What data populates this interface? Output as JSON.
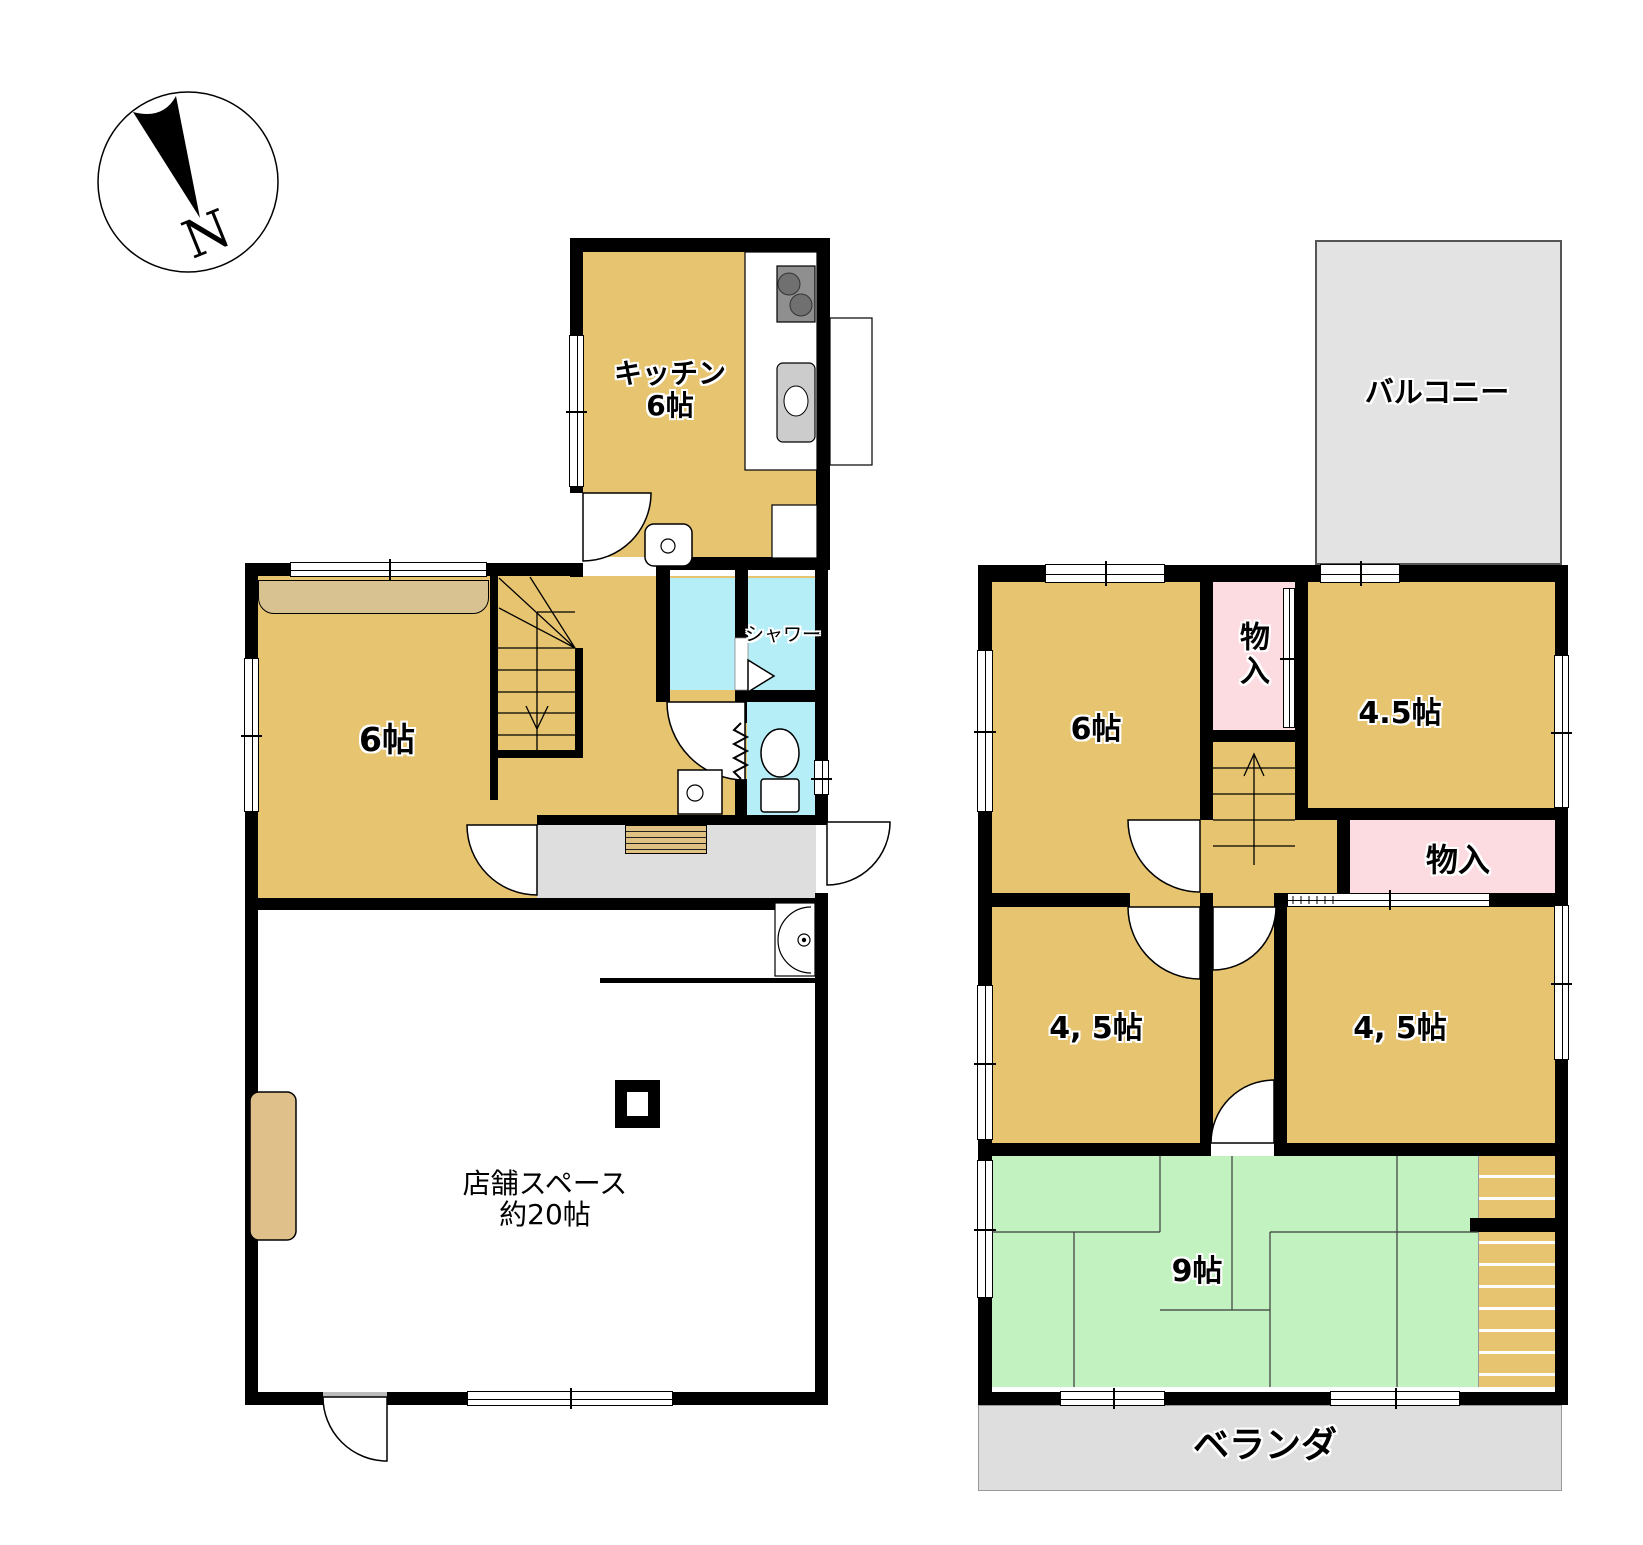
{
  "compass": {
    "north_label": "N"
  },
  "floor1": {
    "kitchen": {
      "label": "キッチン",
      "size": "6帖"
    },
    "living_room": {
      "size": "6帖"
    },
    "shower_room": {
      "label": "シャワー"
    },
    "shop": {
      "label": "店舗スペース",
      "size": "約20帖"
    }
  },
  "floor2": {
    "balcony": {
      "label": "バルコニー"
    },
    "bedroom_nw": {
      "size": "6帖"
    },
    "closet_upper": {
      "label": "物入"
    },
    "bedroom_ne": {
      "size": "4.5帖"
    },
    "closet_lower": {
      "label": "物入"
    },
    "bedroom_sw": {
      "size": "4, 5帖"
    },
    "bedroom_se": {
      "size": "4, 5帖"
    },
    "tatami_room": {
      "size": "9帖"
    },
    "veranda": {
      "label": "ベランダ"
    }
  },
  "colors": {
    "room_tan": "#e7c46f",
    "closet_band_tan": "#d8c291",
    "wet_area_cyan": "#b5eef7",
    "closet_pink": "#fcdce1",
    "tatami_green": "#c2f2c0",
    "balcony_gray": "#e3e3e3",
    "wall_black": "#000000"
  }
}
